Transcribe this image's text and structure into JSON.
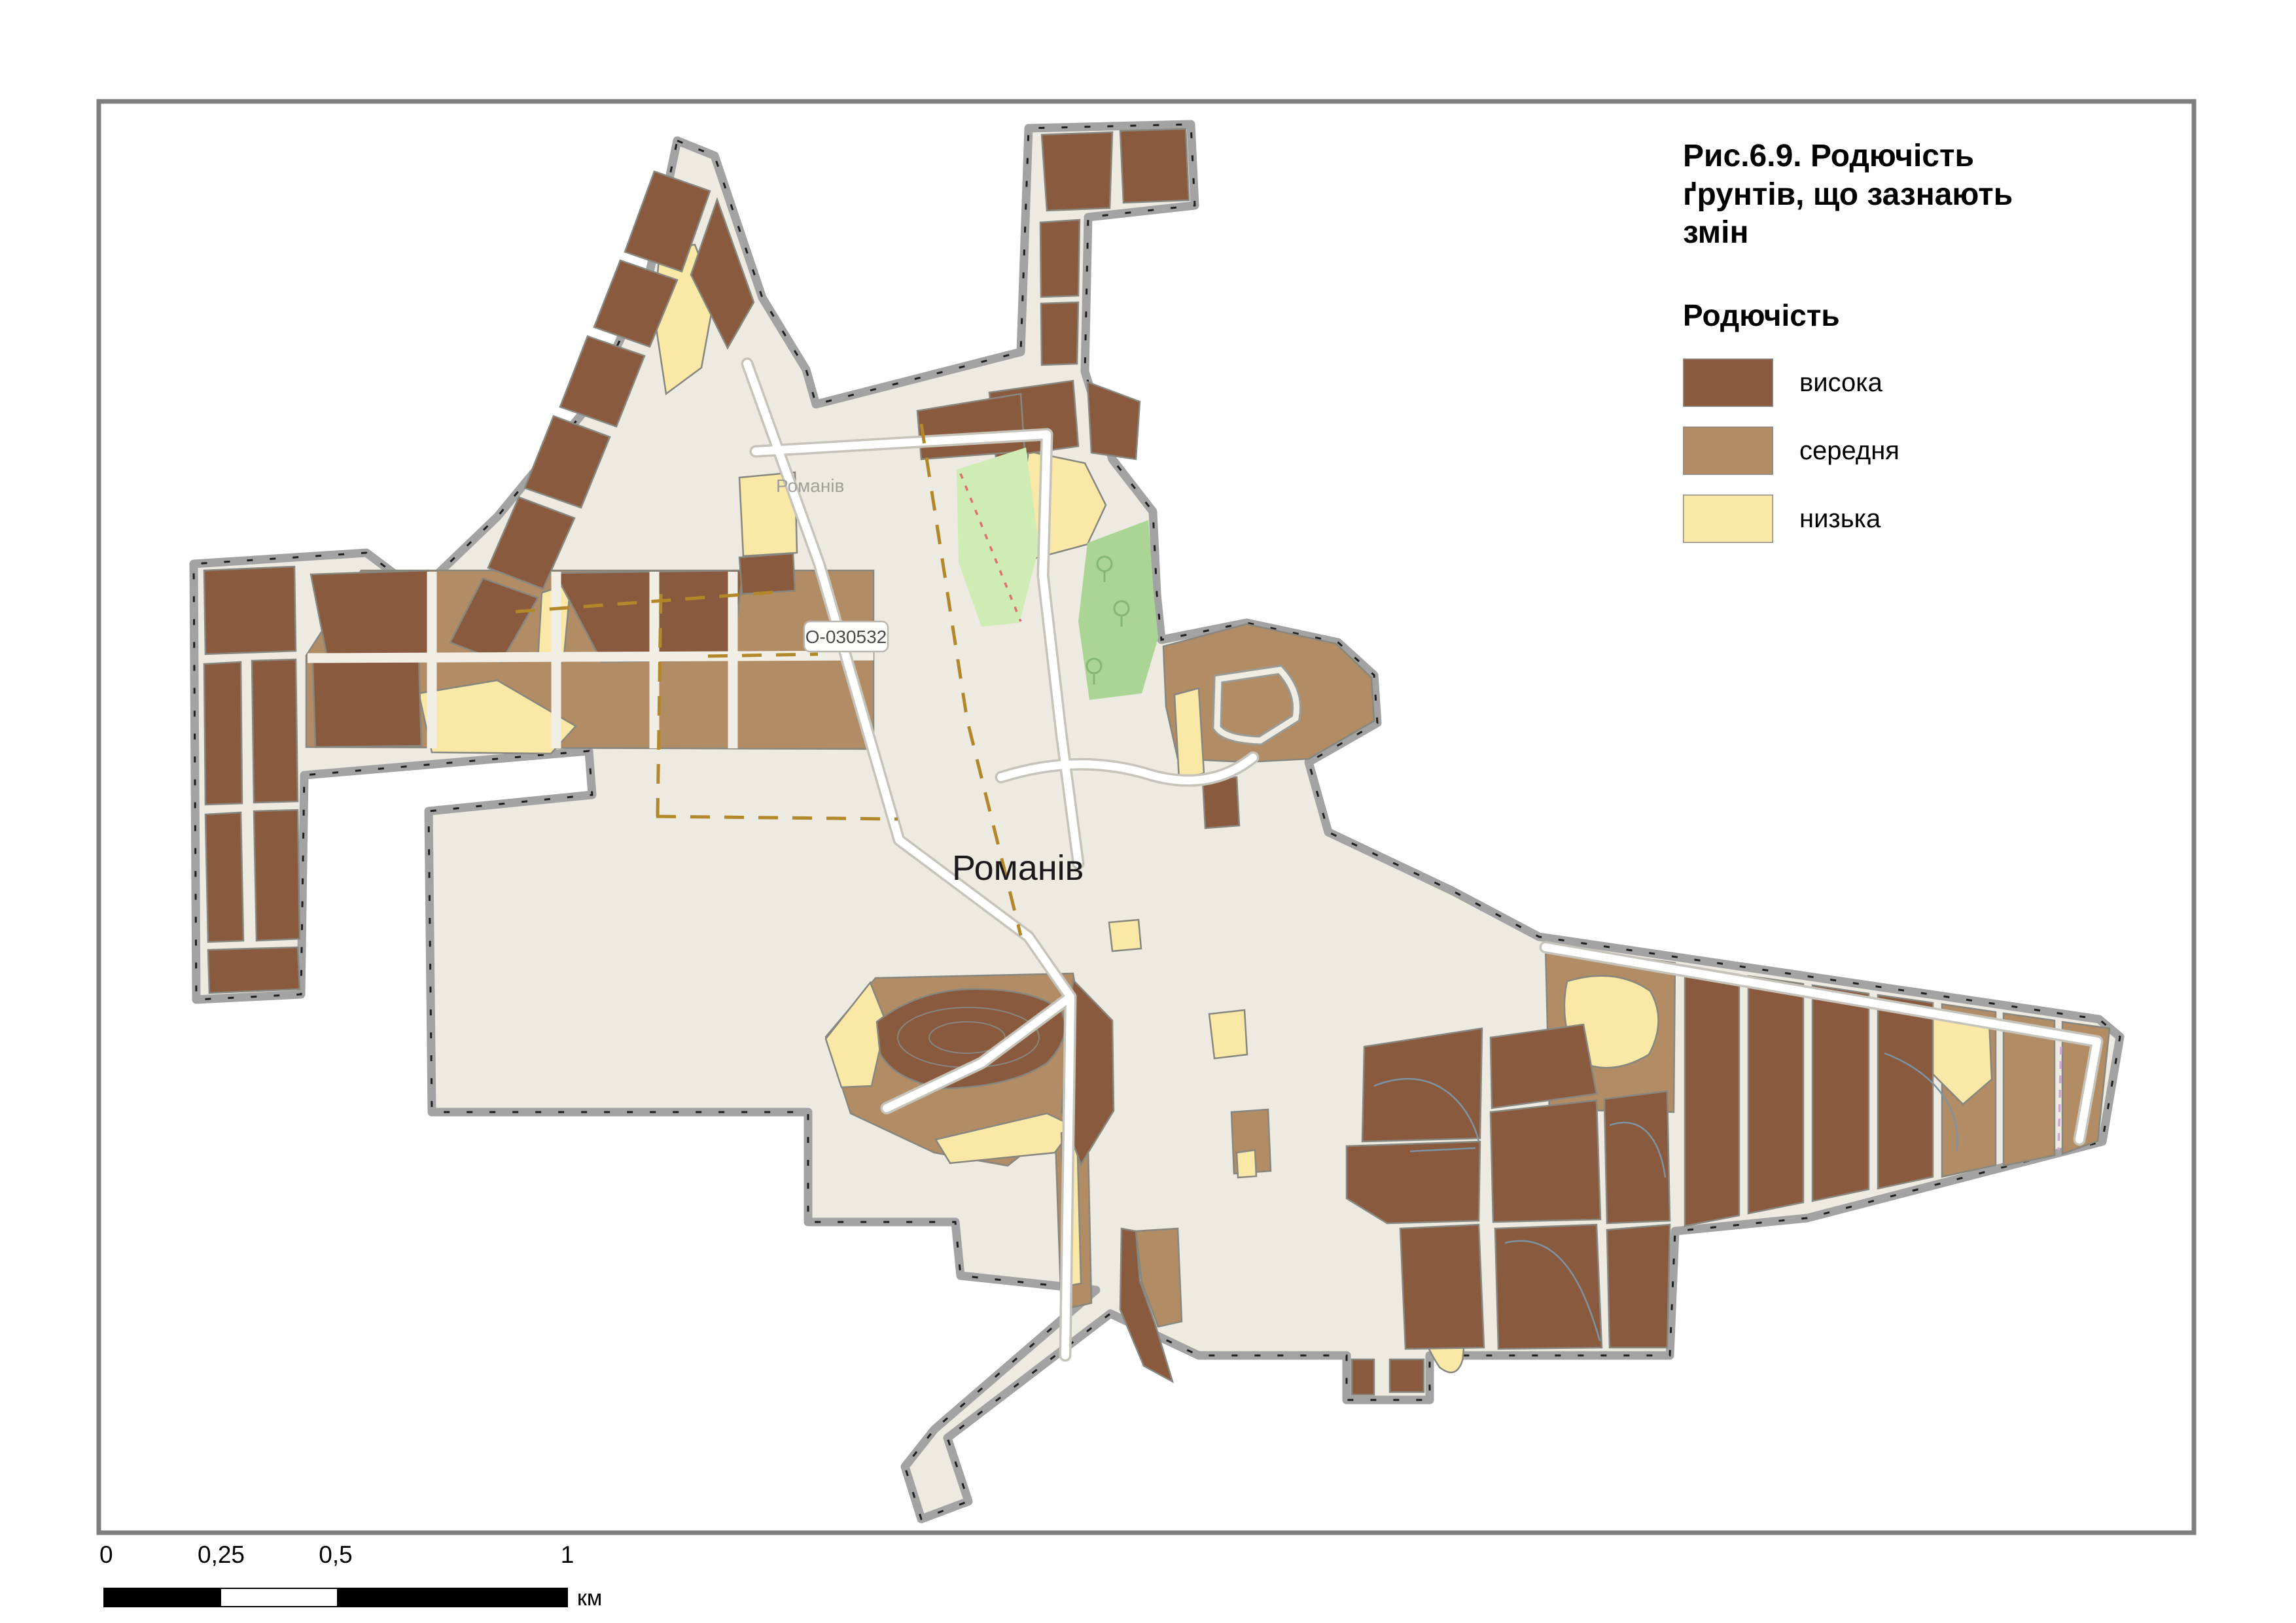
{
  "figure": {
    "title": "Рис.6.9. Родючість\nґрунтів, що зазнають\nзмін"
  },
  "legend": {
    "heading": "Родючість",
    "items": [
      {
        "label": "висока",
        "color": "#8a5a3e"
      },
      {
        "label": "середня",
        "color": "#b18c65"
      },
      {
        "label": "низька",
        "color": "#fae8a6"
      }
    ]
  },
  "map_labels": {
    "settlement_major": "Романів",
    "settlement_minor": "Романів",
    "road_ref": "О-030532"
  },
  "scalebar": {
    "tick0": "0",
    "tick1": "0,25",
    "tick2": "0,5",
    "tick3": "1",
    "unit": "км"
  },
  "colors": {
    "fertility_high": "#8a5a3e",
    "fertility_medium": "#b18c65",
    "fertility_low": "#fae8a6",
    "settlement_fill": "#edeae2",
    "boundary_gray": "#a3a3a3",
    "frame_gray": "#7f7f7f",
    "park_green": "#cfecb4",
    "forest_green": "#abd595",
    "road_casing": "#c6c3bb",
    "road_white": "#ffffff",
    "street_gap": "#f1eee6",
    "track_dash": "#b2882a",
    "parcel_line": "#7e93a3",
    "minor_label_gray": "#a0a098"
  }
}
